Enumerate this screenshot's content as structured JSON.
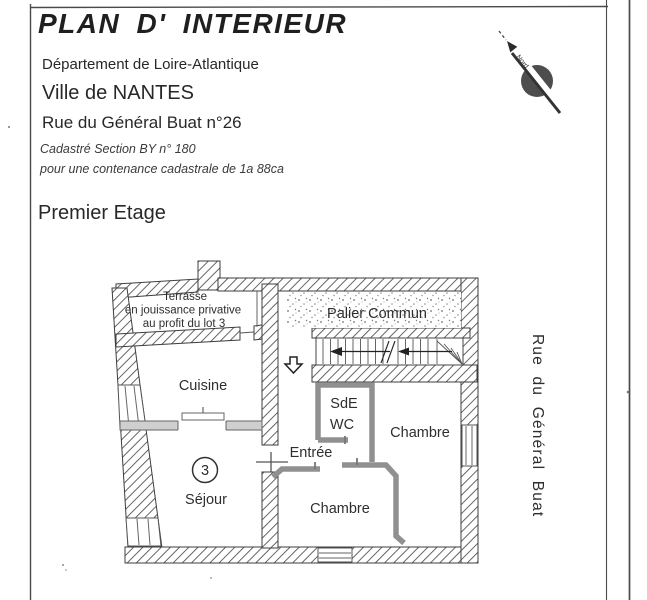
{
  "document": {
    "title": "PLAN D' INTERIEUR",
    "department": "Département de Loire-Atlantique",
    "city": "Ville de NANTES",
    "address": "Rue du Général Buat n°26",
    "cadastre_section": "Cadastré Section BY n° 180",
    "cadastre_area": "pour une contenance cadastrale de 1a 88ca",
    "floor": "Premier Etage"
  },
  "compass": {
    "north_label": "Nord"
  },
  "street": {
    "label": "Rue du Général Buat"
  },
  "plan": {
    "terrace": {
      "line1": "Terrasse",
      "line2": "en jouissance privative",
      "line3": "au profit du lot 3"
    },
    "landing": "Palier Commun",
    "kitchen": "Cuisine",
    "shower_room": "SdE",
    "wc": "WC",
    "bedroom_right": "Chambre",
    "bedroom_bottom": "Chambre",
    "entrance": "Entrée",
    "living_room": "Séjour",
    "lot_number": "3"
  },
  "colors": {
    "ink": "#2e2e2e",
    "wall_line": "#3d3d3d",
    "partition_gray": "#909090",
    "paper": "#ffffff"
  }
}
